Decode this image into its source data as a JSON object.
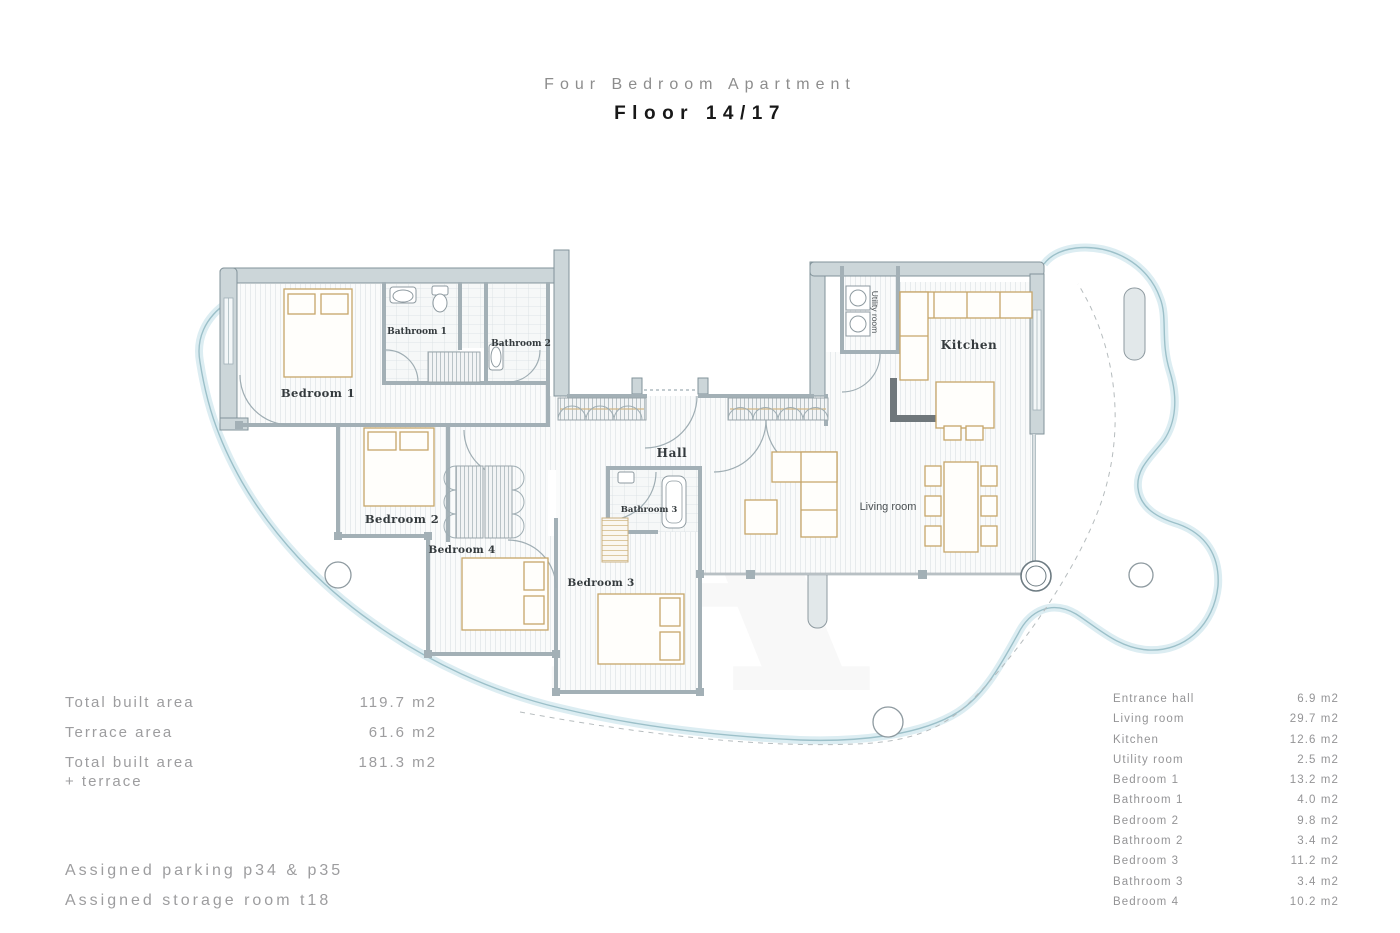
{
  "title": {
    "line1": "Four Bedroom Apartment",
    "line2": "Floor 14/17"
  },
  "plan_labels": {
    "bedroom1": "Bedroom 1",
    "bedroom2": "Bedroom 2",
    "bedroom3": "Bedroom 3",
    "bedroom4": "Bedroom 4",
    "bathroom1": "Bathroom 1",
    "bathroom2": "Bathroom 2",
    "bathroom3": "Bathroom 3",
    "hall": "Hall",
    "kitchen": "Kitchen",
    "living_room": "Living room",
    "utility_room": "Utility room"
  },
  "summary": {
    "rows": [
      {
        "label": "Total built area",
        "label2": "",
        "value": "119.7 m2"
      },
      {
        "label": "Terrace area",
        "label2": "",
        "value": "61.6 m2"
      },
      {
        "label": "Total built area",
        "label2": "+ terrace",
        "value": "181.3 m2"
      }
    ]
  },
  "assignments": {
    "line1": "Assigned parking p34 & p35",
    "line2": "Assigned storage room t18"
  },
  "room_areas": [
    {
      "label": "Entrance hall",
      "value": "6.9 m2"
    },
    {
      "label": "Living room",
      "value": "29.7 m2"
    },
    {
      "label": "Kitchen",
      "value": "12.6 m2"
    },
    {
      "label": "Utility room",
      "value": "2.5 m2"
    },
    {
      "label": "Bedroom 1",
      "value": "13.2 m2"
    },
    {
      "label": "Bathroom 1",
      "value": "4.0 m2"
    },
    {
      "label": "Bedroom 2",
      "value": "9.8 m2"
    },
    {
      "label": "Bathroom 2",
      "value": "3.4 m2"
    },
    {
      "label": "Bedroom 3",
      "value": "11.2 m2"
    },
    {
      "label": "Bathroom 3",
      "value": "3.4 m2"
    },
    {
      "label": "Bedroom 4",
      "value": "10.2 m2"
    }
  ],
  "colors": {
    "wall_fill": "#ccd6d9",
    "wall_stroke": "#82939a",
    "inner_wall": "#a3b0b6",
    "terrace_fill": "#dcedf2",
    "terrace_stroke": "#9cc0c9",
    "furniture": "#c6a66a",
    "label_text": "#343a3d",
    "muted_text": "#9d9d9f",
    "dark_text": "#181818"
  }
}
